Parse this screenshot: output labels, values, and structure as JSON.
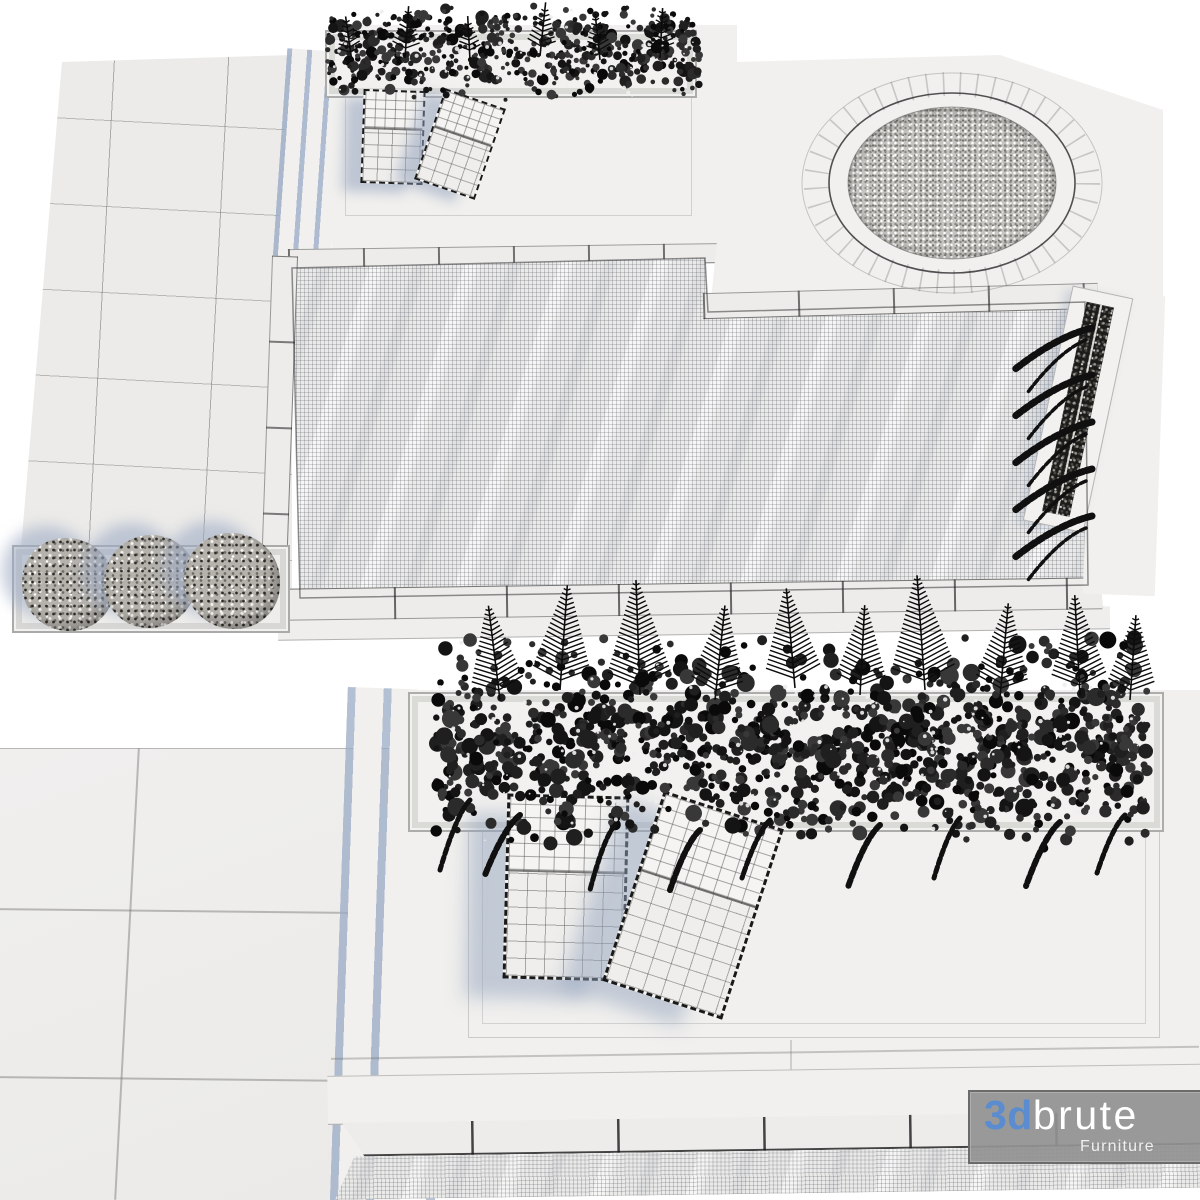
{
  "watermark": {
    "brand_prefix": "3d",
    "brand_suffix": "brute",
    "tagline": "Furniture",
    "accent_color": "#5b8ccf",
    "text_color": "#ffffff",
    "panel_color": "#929292"
  },
  "palette": {
    "background": "#ffffff",
    "deck": "#f1f0ee",
    "paving": "#ecebe9",
    "coping": "#edecea",
    "water_mesh_line": "#4b505c",
    "shadow_blue": "#94a3be",
    "foliage_dark": "#121212",
    "bush_gray": "#b5b2ac",
    "gravel_dark": "#1b1b1a"
  }
}
